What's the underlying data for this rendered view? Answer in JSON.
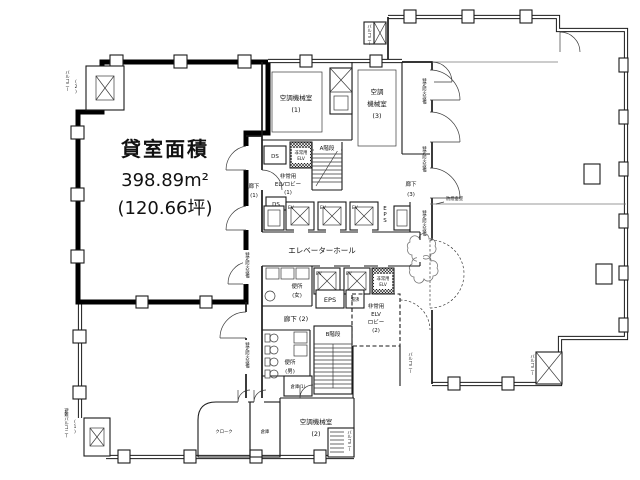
{
  "drawing_type": "floor-plan",
  "colors": {
    "background": "#ffffff",
    "wall": "#1a1a1a",
    "unit_outline": "#000000",
    "text": "#111111"
  },
  "labels": {
    "unit_title": "貸室面積",
    "unit_area_m2": "398.89m²",
    "unit_area_tsubo": "(120.66坪)",
    "balcony2": "バルコニー",
    "escape_balcony": "避難バルコニー",
    "no1": "(1)",
    "no2": "(2)",
    "no3": "(3)",
    "kikai": "空調機械室",
    "kikai3_l1": "空調",
    "kikai3_l2": "機械室",
    "stair_a": "A階段",
    "stair_b": "B階段",
    "ds": "DS",
    "eps": "EPS",
    "ev": "EV",
    "emerg_l1": "非常用",
    "emerg_l2": "ELV",
    "lobby1_l2": "ELVロビー",
    "lobby2_l2": "ELV",
    "lobby2_l3": "ロビー",
    "rouka": "廊下",
    "rouka2": "廊下 (2)",
    "ev_hall": "エレベーターホール",
    "wc": "便所",
    "wc_w": "(女)",
    "wc_m": "(男)",
    "souko1": "倉庫(1)",
    "souko": "倉庫",
    "cloak": "クローク",
    "yuwakashi": "湯沸",
    "smoke_wall": "防煙垂壁",
    "fire_tag": "特定防火設備",
    "balcony_tag": "バルコニー"
  }
}
